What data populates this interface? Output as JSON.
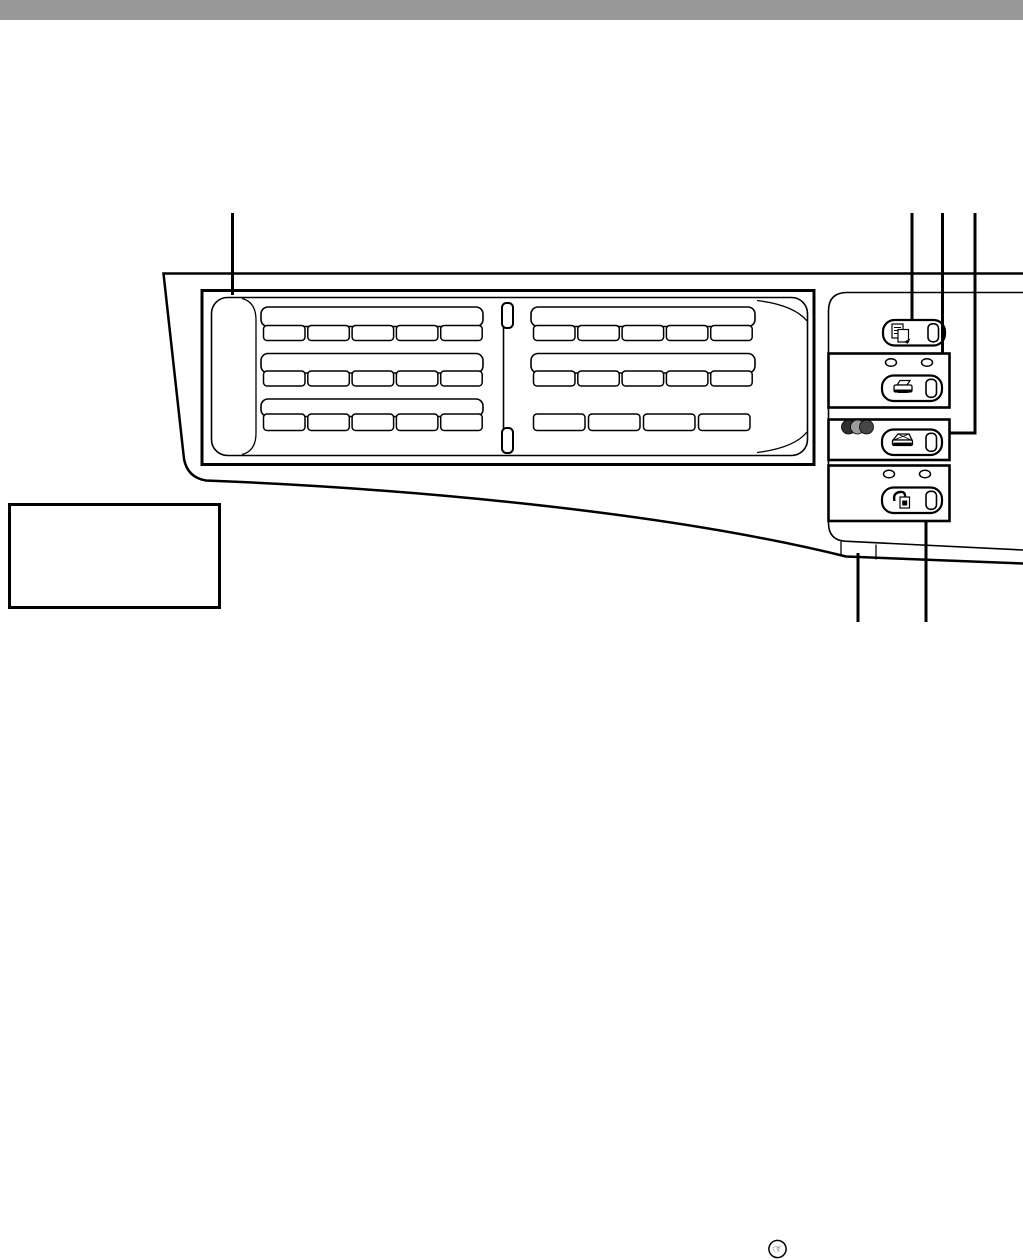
{
  "page": {
    "background": "#ffffff",
    "top_bar_color": "#999999"
  },
  "figure": {
    "kind": "control-panel-line-drawing",
    "stroke_color": "#000000",
    "fill_color": "#ffffff",
    "keypad": {
      "left_group": {
        "label_bars": 3,
        "buttons_per_row": [
          5,
          5,
          5
        ]
      },
      "right_group": {
        "label_bars": 2,
        "buttons_per_row": [
          5,
          5,
          4
        ]
      }
    },
    "mode_sections": {
      "copy": {
        "icon": "copy-icon"
      },
      "print": {
        "icon": "printer-icon",
        "led_count": 2
      },
      "scan": {
        "icon": "scanner-icon",
        "color_dot_colors": [
          "#2f2f2f",
          "#9b9b9b",
          "#464646"
        ]
      },
      "fax": {
        "icon": "fax-icon",
        "led_count": 2
      }
    },
    "callout_lines": {
      "top": 4,
      "bottom": 2
    },
    "reference_icon_glyph": "☞"
  },
  "note_box": {
    "text": ""
  }
}
